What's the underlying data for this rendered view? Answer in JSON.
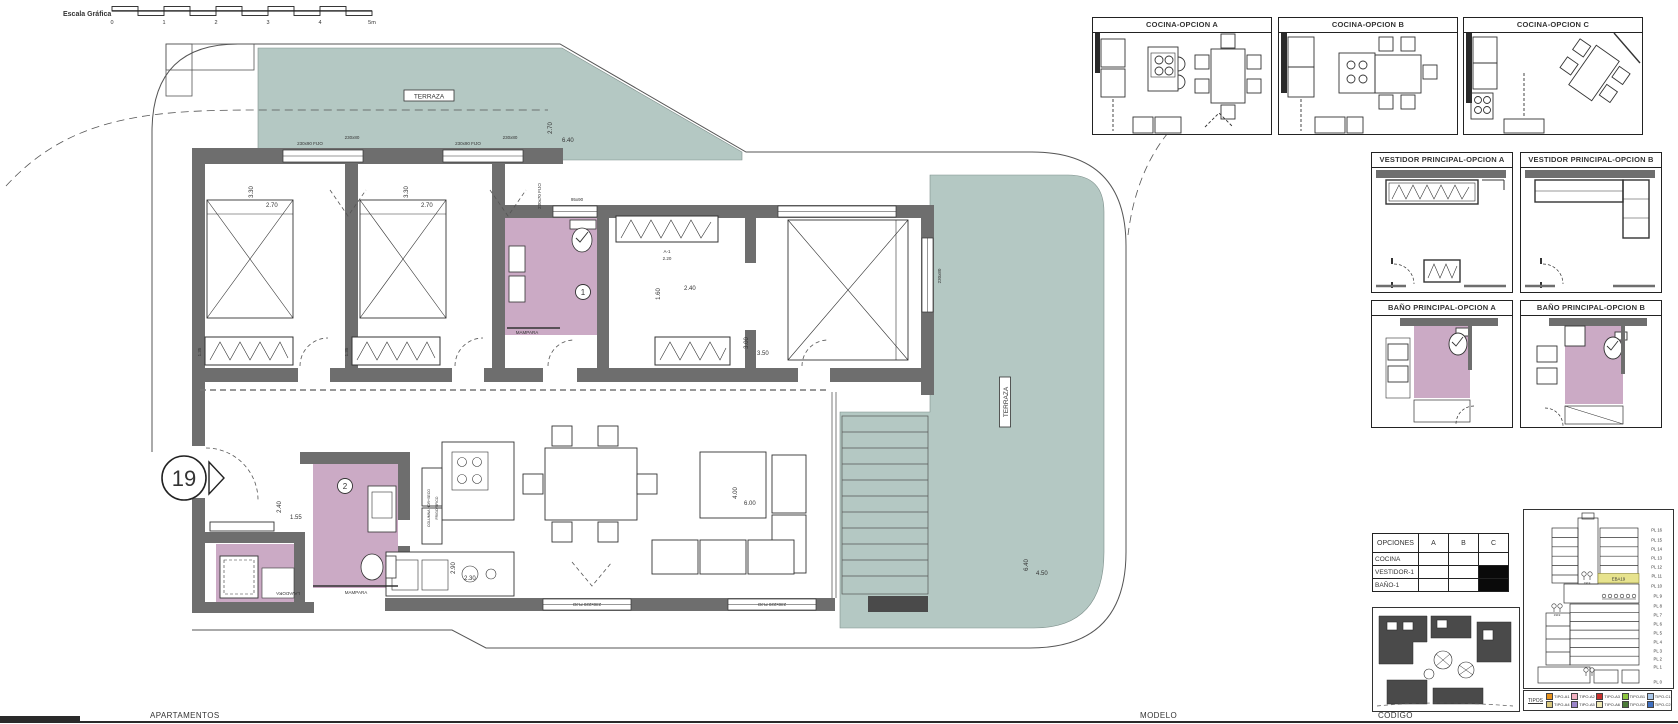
{
  "scale_bar": {
    "label": "Escala Gráfica",
    "ticks": [
      "0",
      "1",
      "2",
      "3",
      "4",
      "5m"
    ]
  },
  "colors": {
    "terrace": "#b4c8c3",
    "bath": "#cbaac5",
    "wall": "#6e6e6e",
    "highlight": "#e7e38e"
  },
  "plan": {
    "entry_number": "19",
    "labels": {
      "terraza_top": "TERRAZA",
      "terraza_right": "TERRAZA",
      "bath1_num": "1",
      "bath2_num": "2",
      "mampara1": "MAMPARA",
      "mampara2": "MAMPARA",
      "lavadora": "LAVADORA",
      "columna": "COLUMNA HOR+SECO",
      "frigorifico": "FRIGORIFICO",
      "a1_code": "A-1",
      "a1_dim": "2.20"
    },
    "windows": {
      "top1": "230x90 FIJO",
      "top2": "230x80",
      "top3": "230x90 FIJO",
      "top4": "230x80",
      "bath1": "95x90",
      "hall_v": "230x70 FIJO",
      "master_v": "230x80",
      "bottom1": "230x220 FIJO",
      "bottom2": "230x220 FIJO"
    },
    "dims": {
      "bed1_h": "3.30",
      "bed1_w": "2.70",
      "bed2_h": "3.30",
      "bed2_w": "2.70",
      "ward1": "1.35",
      "ward2": "1.35",
      "terr_top_h": "2.70",
      "terr_top_w": "6.40",
      "hall_h": "1.60",
      "hall_w": "2.40",
      "master_h": "3.00",
      "master_w": "3.50",
      "living_h": "4.00",
      "living_w": "6.00",
      "kitchen_h": "2.90",
      "kitchen_w": "2.30",
      "entry_h": "2.40",
      "entry_w": "1.55",
      "terr_right_h": "6.40",
      "terr_right_w": "4.50"
    }
  },
  "panels": {
    "cocina_a": "COCINA-OPCION A",
    "cocina_b": "COCINA-OPCION B",
    "cocina_c": "COCINA-OPCION C",
    "vestidor_a": "VESTIDOR PRINCIPAL-OPCION A",
    "vestidor_b": "VESTIDOR PRINCIPAL-OPCION B",
    "bano_a": "BAÑO PRINCIPAL-OPCION A",
    "bano_b": "BAÑO PRINCIPAL-OPCION B"
  },
  "options_table": {
    "header": [
      "OPCIONES",
      "A",
      "B",
      "C"
    ],
    "rows": [
      {
        "label": "COCINA",
        "a": "",
        "b": "",
        "c": ""
      },
      {
        "label": "VESTIDOR-1",
        "a": "",
        "b": "",
        "c": "filled"
      },
      {
        "label": "BAÑO-1",
        "a": "",
        "b": "",
        "c": "filled"
      }
    ]
  },
  "elevation": {
    "floors": [
      "PL 16",
      "PL 15",
      "PL 14",
      "PL 13",
      "PL 12",
      "PL 11",
      "PL 10",
      "PL 9",
      "PL 8",
      "PL 7",
      "PL 6",
      "PL 5",
      "PL 4",
      "PL 3",
      "PL 2",
      "PL 1",
      "PL 0"
    ],
    "unit_code": "EBA19",
    "glyph_code": "1919",
    "tipos_label": "TIPOS",
    "legend": [
      {
        "label": "TIPO-A1",
        "color": "#e8921c"
      },
      {
        "label": "TIPO-A2",
        "color": "#f2afc0"
      },
      {
        "label": "TIPO-A3",
        "color": "#c9302c"
      },
      {
        "label": "TIPO-B1",
        "color": "#8dc63f"
      },
      {
        "label": "TIPO-C1",
        "color": "#a9c7e9"
      },
      {
        "label": "TIPO-A4",
        "color": "#d9c87e"
      },
      {
        "label": "TIPO-A5",
        "color": "#9b85c9"
      },
      {
        "label": "TIPO-A6",
        "color": "#eee8b4"
      },
      {
        "label": "TIPO-B2",
        "color": "#4b7a38"
      },
      {
        "label": "TIPO-C2",
        "color": "#3e6fc0"
      }
    ]
  },
  "footer": {
    "apartamentos": "APARTAMENTOS",
    "modelo": "MODELO",
    "codigo": "CODIGO"
  }
}
